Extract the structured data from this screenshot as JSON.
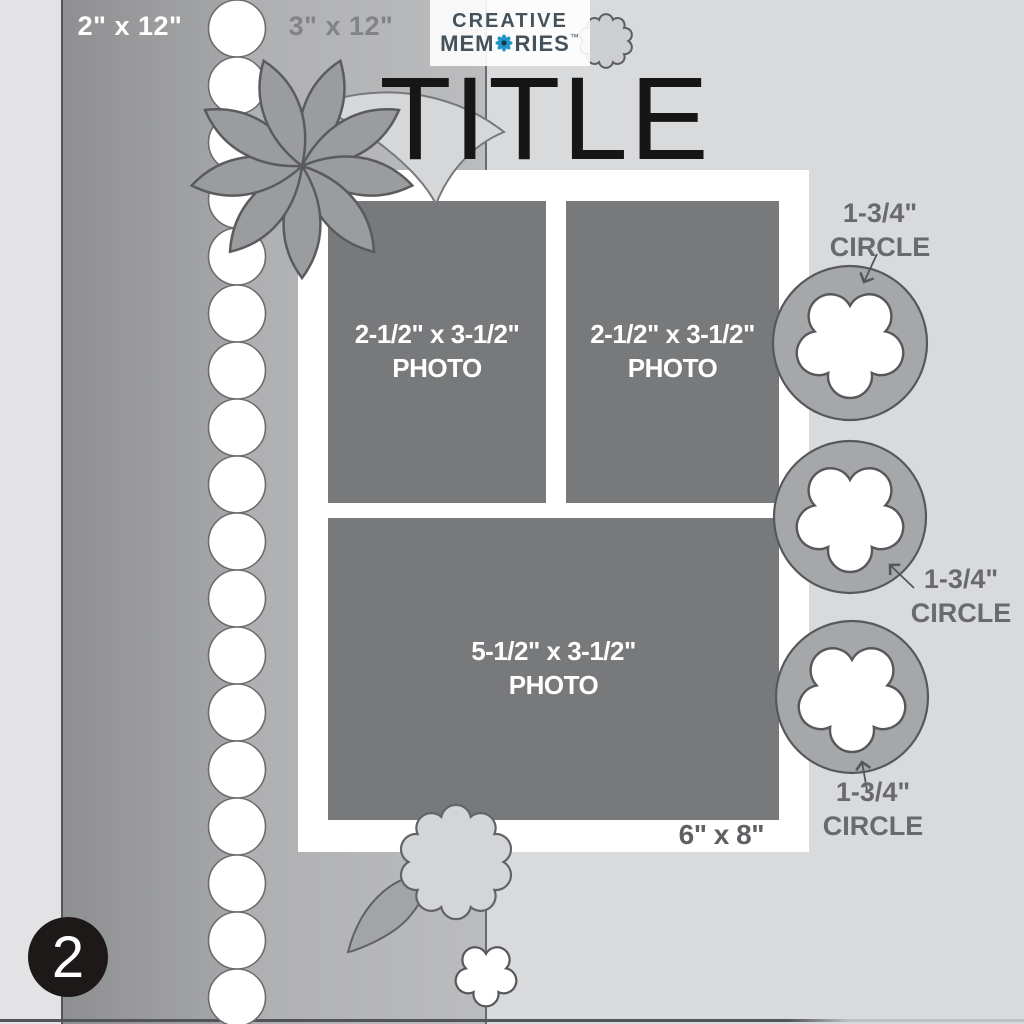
{
  "brand": {
    "line1": "CREATIVE",
    "line2_pre": "MEM",
    "line2_post": "RIES",
    "trademark": "™",
    "flower_color": "#2095c8"
  },
  "title": "TITLE",
  "page_number": "2",
  "papers": {
    "strip_2x12": "2\" x 12\"",
    "strip_3x12": "3\" x 12\""
  },
  "mat": {
    "size_label": "6\" x 8\""
  },
  "photos": [
    {
      "size": "2-1/2\" x 3-1/2\"",
      "caption": "PHOTO"
    },
    {
      "size": "2-1/2\" x 3-1/2\"",
      "caption": "PHOTO"
    },
    {
      "size": "5-1/2\" x 3-1/2\"",
      "caption": "PHOTO"
    }
  ],
  "punches": [
    {
      "size": "1-3/4\"",
      "shape": "CIRCLE"
    },
    {
      "size": "1-3/4\"",
      "shape": "CIRCLE"
    },
    {
      "size": "1-3/4\"",
      "shape": "CIRCLE"
    }
  ],
  "decor": {
    "scallop_count": 18
  },
  "colors": {
    "background": "#d9dadc",
    "left_strip": "#e3e3e5",
    "paper_2x12": "#98999b",
    "paper_3x12": "#b3b4b6",
    "photo_fill": "#77797b",
    "mat_fill": "#ffffff",
    "punch_circle_fill": "#a6a7a9",
    "outline": "#57585b",
    "label_gray": "#696a6d",
    "accent_blue": "#2095c8",
    "badge_black": "#1d1919"
  }
}
